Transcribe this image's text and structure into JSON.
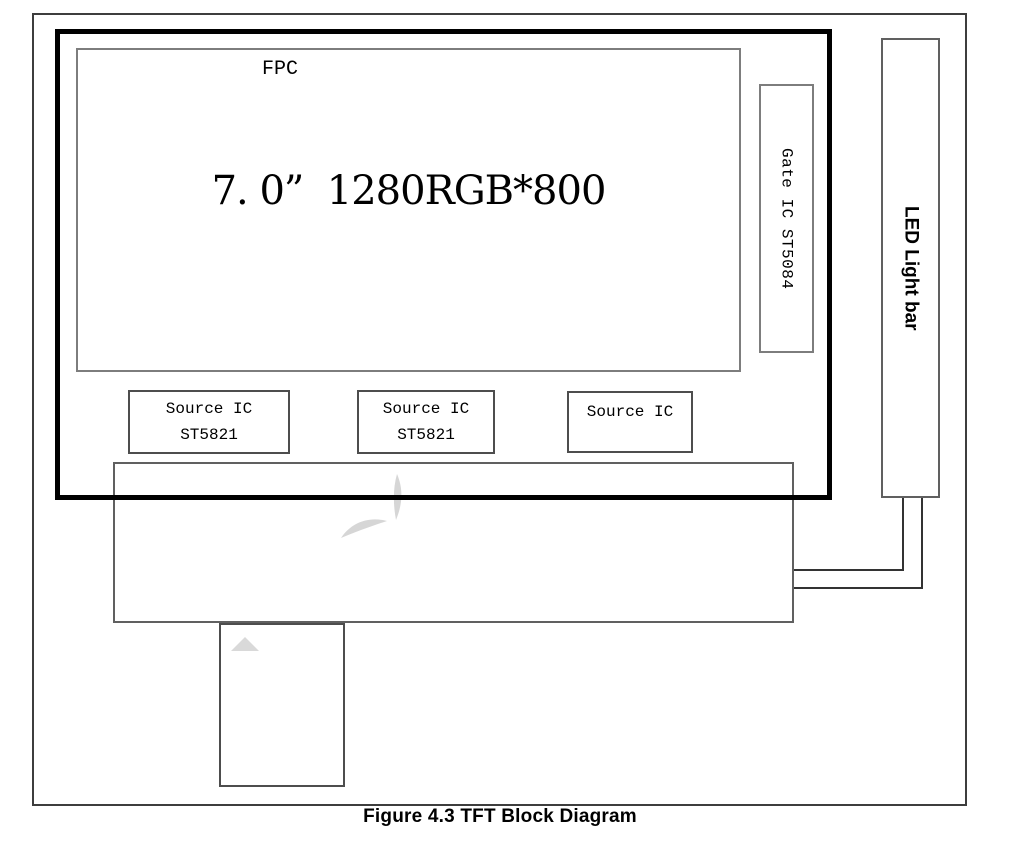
{
  "diagram": {
    "caption": "Figure 4.3 TFT Block Diagram",
    "display": {
      "label": "7. 0”  1280RGB*800"
    },
    "gate_ic": {
      "label": "Gate IC ST5084"
    },
    "source_ics": [
      {
        "line1": "Source IC",
        "line2": "ST5821"
      },
      {
        "line1": "Source IC",
        "line2": "ST5821"
      },
      {
        "line1": "Source IC"
      }
    ],
    "fpc": {
      "label": "FPC"
    },
    "led": {
      "label": "LED Light bar"
    },
    "icons": {
      "watermark": "logo-watermark-fragment",
      "triangle": "watermark-triangle"
    },
    "colors": {
      "background": "#ffffff",
      "thick_outline": "#000000",
      "thin_border": "#606060",
      "gray_border": "#7d7d7d",
      "watermark": "#d6d6d6"
    }
  }
}
